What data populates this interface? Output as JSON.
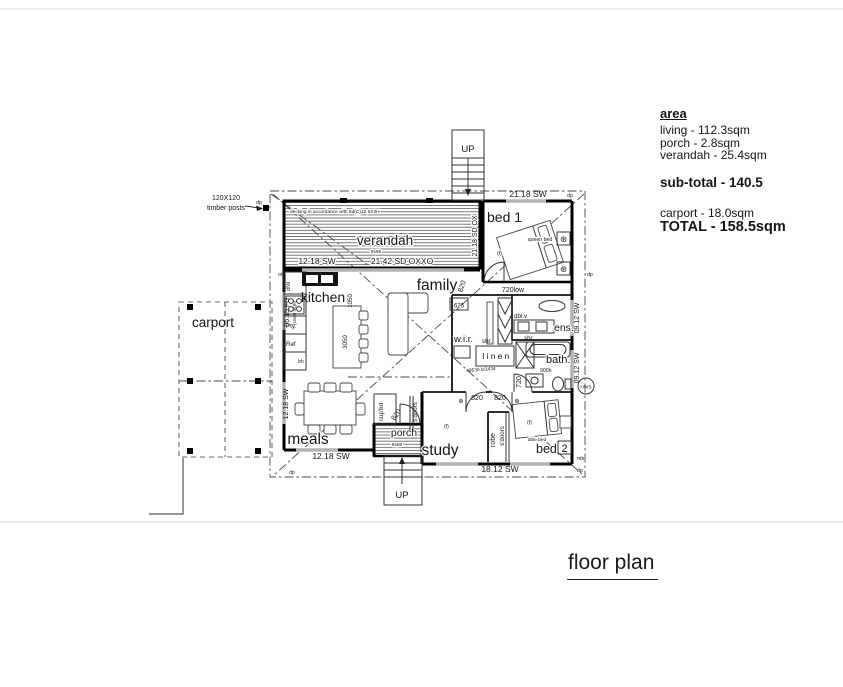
{
  "title": "floor plan",
  "panel": {
    "heading": "area",
    "living": "living - 112.3sqm",
    "porch": "porch - 2.8sqm",
    "verandah": "verandah - 25.4sqm",
    "subtotal": "sub-total - 140.5",
    "carport": "carport - 18.0sqm",
    "total": "TOTAL - 158.5sqm"
  },
  "rooms": {
    "verandah": "verandah",
    "bed1": "bed 1",
    "family": "family",
    "kitchen": "kitchen",
    "carport": "carport",
    "meals": "meals",
    "porch": "porch",
    "study": "study",
    "bed2_word": "bed",
    "bed2_num": "2",
    "bath": "bath.",
    "ens": "ens.",
    "wir": "w.i.r.",
    "linen": "linen",
    "robe": "robe"
  },
  "dims": {
    "top": "21.18 SW",
    "verandah_door": "21.42 SD OXXO",
    "verandah_sw": "12.18 SW",
    "verandah_east": "21.18 SD OX",
    "left_fg": "06.15 FG",
    "left_fg_note": "(1500 high)",
    "left_sw": "12.18 SW",
    "meals_sw": "12.18 SW",
    "bottom_sw": "18.12 SW",
    "right_sw": "09.12 SW",
    "low_window": "720low",
    "cup625": "625",
    "i1050": "1050",
    "i3050": "3050",
    "h900": "900h",
    "code": "46630 b/1434"
  },
  "doors": {
    "d820": "820",
    "d720": "720"
  },
  "labels": {
    "up": "UP",
    "dp": "dp",
    "mb": "mb",
    "hws": "HWS",
    "f": "(f)",
    "queen": "queen bed",
    "dble": "dble.bed",
    "dblv": "dbl.v",
    "shr": "shr.",
    "sdoors": "s'doors",
    "cupbd": "cup'bd",
    "pty": "Pty.",
    "ref": "Ref",
    "dw": "d/W",
    "bh": "bh",
    "ot": "ot",
    "posts1": "120X120",
    "posts2": "timber posts",
    "deck_note": "decking in accordance with 6d(C)12 6X3H",
    "deck_size": "9x68"
  },
  "symbols": {
    "star": "⊛"
  }
}
